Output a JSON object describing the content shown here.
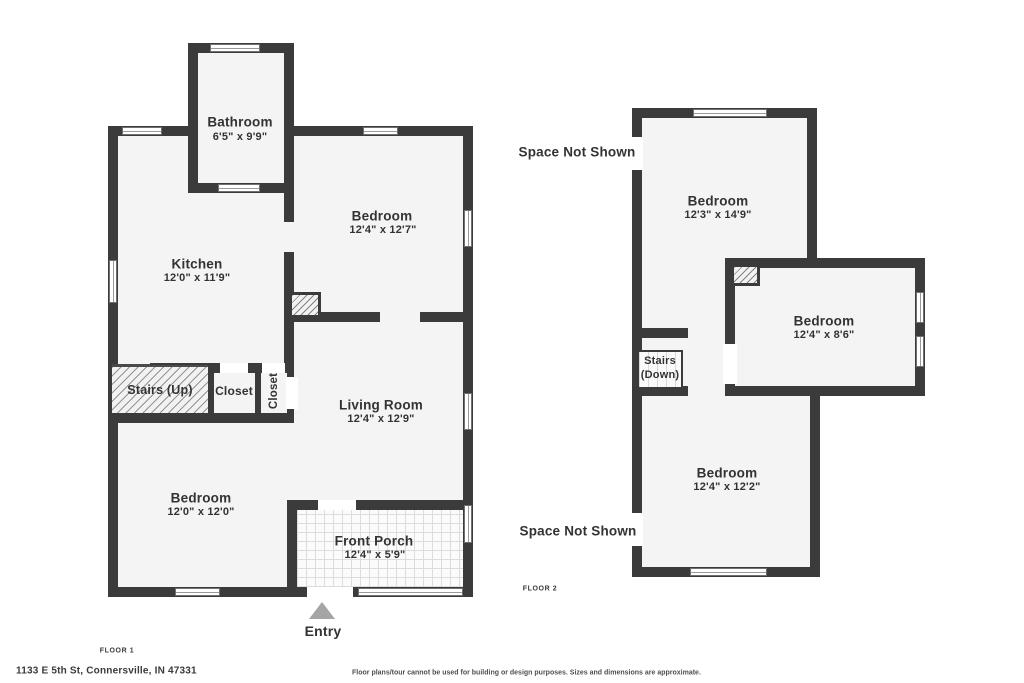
{
  "address": "1133 E 5th St, Connersville, IN 47331",
  "disclaimer": "Floor plans/tour cannot be used for building or design purposes. Sizes and dimensions are approximate.",
  "colors": {
    "wall": "#3b3b3b",
    "floor_fill": "#f4f4f4",
    "entry_arrow": "#a5a5a5",
    "text": "#333333"
  },
  "floor1": {
    "label": "FLOOR 1",
    "entry_label": "Entry",
    "rooms": {
      "bathroom": {
        "name": "Bathroom",
        "dims": "6'5\" x 9'9\""
      },
      "bedroom_top": {
        "name": "Bedroom",
        "dims": "12'4\" x 12'7\""
      },
      "kitchen": {
        "name": "Kitchen",
        "dims": "12'0\" x 11'9\""
      },
      "stairs": {
        "name": "Stairs (Up)"
      },
      "closet_a": {
        "name": "Closet"
      },
      "closet_b": {
        "name": "Closet"
      },
      "living_room": {
        "name": "Living Room",
        "dims": "12'4\" x 12'9\""
      },
      "bedroom_bottom": {
        "name": "Bedroom",
        "dims": "12'0\" x 12'0\""
      },
      "front_porch": {
        "name": "Front Porch",
        "dims": "12'4\" x 5'9\""
      }
    }
  },
  "floor2": {
    "label": "FLOOR 2",
    "space_not_shown_top": "Space Not Shown",
    "space_not_shown_bottom": "Space Not Shown",
    "rooms": {
      "bedroom_top": {
        "name": "Bedroom",
        "dims": "12'3\" x 14'9\""
      },
      "bedroom_right": {
        "name": "Bedroom",
        "dims": "12'4\" x 8'6\""
      },
      "stairs": {
        "line1": "Stairs",
        "line2": "(Down)"
      },
      "bedroom_bottom": {
        "name": "Bedroom",
        "dims": "12'4\" x 12'2\""
      }
    }
  }
}
